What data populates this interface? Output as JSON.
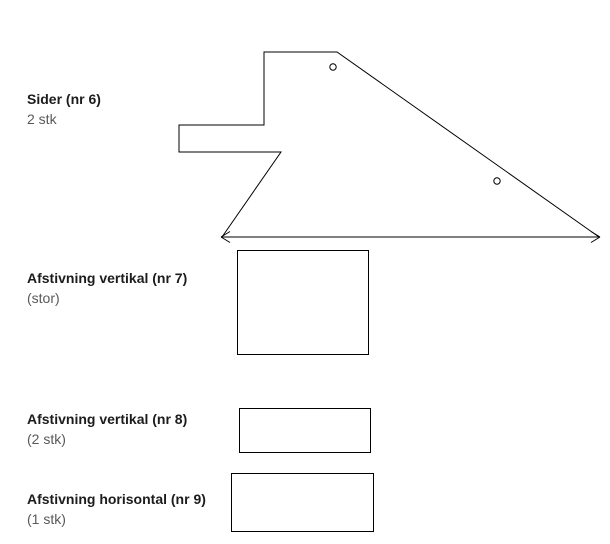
{
  "diagram": {
    "parts": [
      {
        "title": "Sider (nr 6)",
        "subtitle": "2 stk"
      },
      {
        "title": "Afstivning vertikal (nr 7)",
        "subtitle": "(stor)"
      },
      {
        "title": "Afstivning vertikal (nr 8)",
        "subtitle": "(2 stk)"
      },
      {
        "title": "Afstivning horisontal (nr 9)",
        "subtitle": "(1 stk)"
      }
    ]
  },
  "colors": {
    "background": "#ffffff",
    "line": "#000000",
    "title_text": "#1c1c1c",
    "subtitle_text": "#595959"
  }
}
